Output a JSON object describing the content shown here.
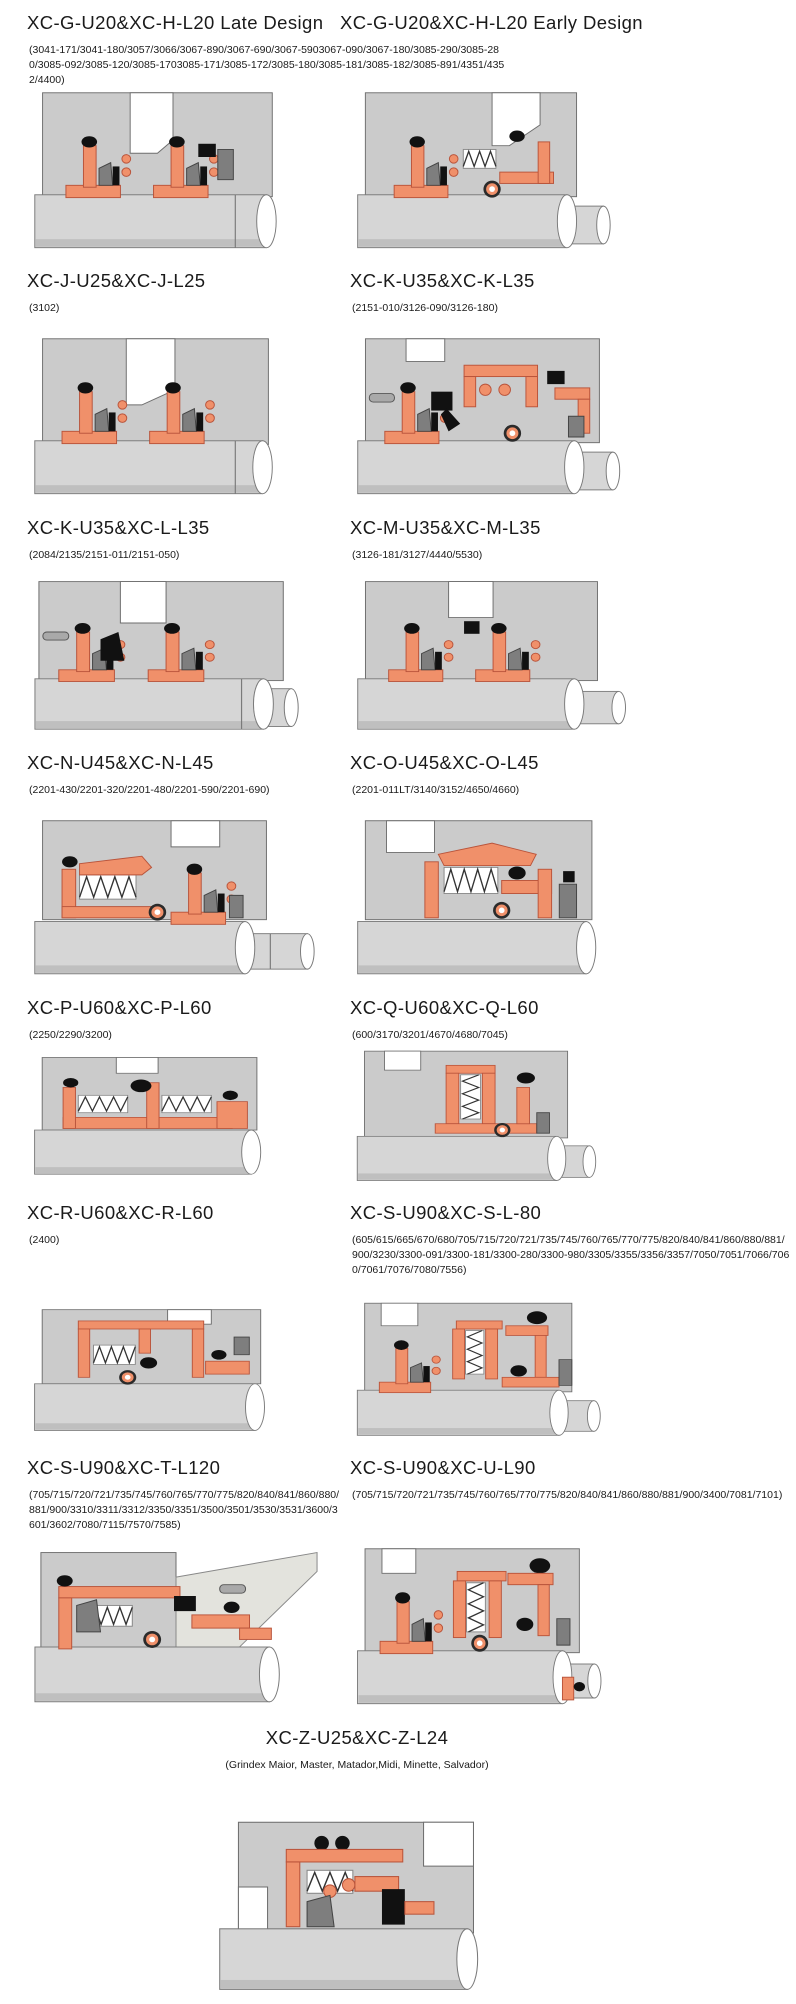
{
  "colors": {
    "housing": "#cbcbcb",
    "housing_line": "#6e6e6e",
    "orange": "#f0906a",
    "orange_line": "#b9543b",
    "black": "#111111",
    "dark_gray": "#7e7e7e",
    "mid_gray": "#a9a9a9",
    "shaft": "#d6d6d6",
    "shaft_shade": "#bfbfbf",
    "outline": "#7a7a7a",
    "wedge_light": "#e3e3dd",
    "text": "#1a1a1a",
    "background": "#ffffff"
  },
  "header_row": {
    "left_title": "XC-G-U20&XC-H-L20 Late Design",
    "right_title": "XC-G-U20&XC-H-L20 Early Design",
    "shared_models": "(3041-171/3041-180/3057/3066/3067-890/3067-690/3067-5903067-090/3067-180/3085-290/3085-280/3085-092/3085-120/3085-1703085-171/3085-172/3085-180/3085-181/3085-182/3085-891/4351/4352/4400)"
  },
  "rows": [
    {
      "left": {
        "title": "XC-J-U25&XC-J-L25",
        "models": "(3102)"
      },
      "right": {
        "title": "XC-K-U35&XC-K-L35",
        "models": "(2151-010/3126-090/3126-180)"
      }
    },
    {
      "left": {
        "title": "XC-K-U35&XC-L-L35",
        "models": "(2084/2135/2151-011/2151-050)"
      },
      "right": {
        "title": "XC-M-U35&XC-M-L35",
        "models": "(3126-181/3127/4440/5530)"
      }
    },
    {
      "left": {
        "title": "XC-N-U45&XC-N-L45",
        "models": "(2201-430/2201-320/2201-480/2201-590/2201-690)"
      },
      "right": {
        "title": "XC-O-U45&XC-O-L45",
        "models": "(2201-011LT/3140/3152/4650/4660)"
      }
    },
    {
      "left": {
        "title": "XC-P-U60&XC-P-L60",
        "models": "(2250/2290/3200)"
      },
      "right": {
        "title": "XC-Q-U60&XC-Q-L60",
        "models": "(600/3170/3201/4670/4680/7045)"
      }
    },
    {
      "left": {
        "title": "XC-R-U60&XC-R-L60",
        "models": "(2400)"
      },
      "right": {
        "title": "XC-S-U90&XC-S-L-80",
        "models": "(605/615/665/670/680/705/715/720/721/735/745/760/765/770/775/820/840/841/860/880/881/900/3230/3300-091/3300-181/3300-280/3300-980/3305/3355/3356/3357/7050/7051/7066/7060/7061/7076/7080/7556)"
      }
    },
    {
      "left": {
        "title": "XC-S-U90&XC-T-L120",
        "models": "(705/715/720/721/735/745/760/765/770/775/820/840/841/860/880/881/900/3310/3311/3312/3350/3351/3500/3501/3530/3531/3600/3601/3602/7080/7115/7570/7585)"
      },
      "right": {
        "title": "XC-S-U90&XC-U-L90",
        "models": "(705/715/720/721/735/745/760/765/770/775/820/840/841/860/880/881/900/3400/7081/7101)"
      }
    }
  ],
  "footer": {
    "title": "XC-Z-U25&XC-Z-L24",
    "models": "(Grindex  Maior, Master, Matador,Midi, Minette, Salvador)"
  }
}
